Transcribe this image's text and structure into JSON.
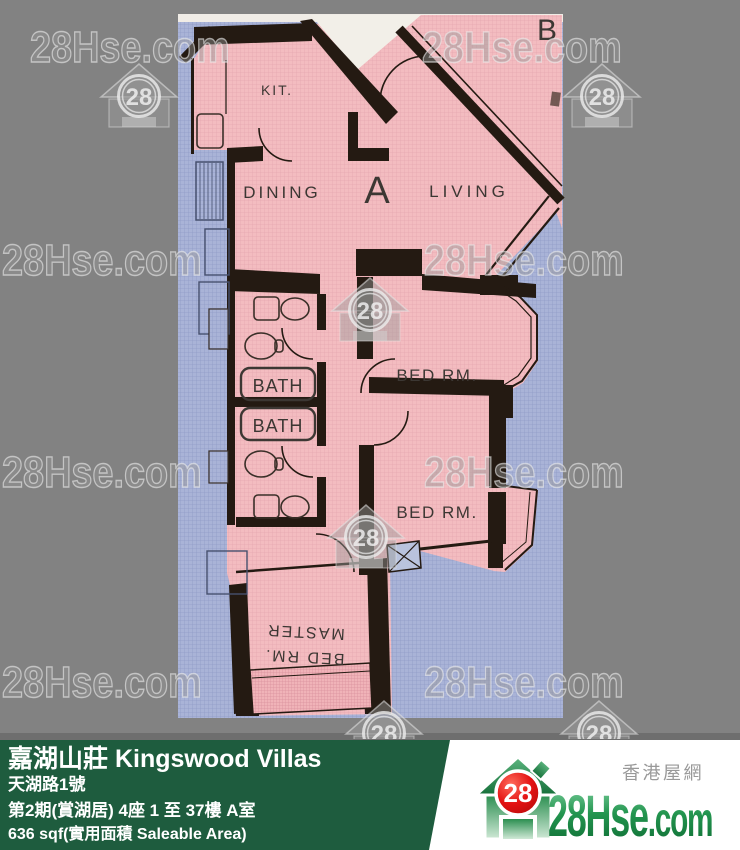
{
  "watermark": {
    "brand": "28Hse.com",
    "logo_number": "28"
  },
  "floor_plan": {
    "unit_label": "A",
    "adjacent_unit_label": "B",
    "labels": {
      "kitchen": "KIT.",
      "dining": "DINING",
      "living": "LIVING",
      "bath_upper": "BATH",
      "bath_lower": "BATH",
      "bedroom_1": "BED RM.",
      "bedroom_2": "BED RM.",
      "master_line_1": "MASTER",
      "master_line_2": "BED RM."
    },
    "colors": {
      "room_fill": "#f3bcc0",
      "outside_fill": "#a9b3d7",
      "wall": "#241a12",
      "lobby_fill": "#f2efe8"
    }
  },
  "info_bar": {
    "title": "嘉湖山莊 Kingswood Villas",
    "address": "天湖路1號",
    "block_info": "第2期(賞湖居) 4座 1 至 37樓 A室",
    "area_info": "636 sqf(實用面積 Saleable Area)",
    "bg_color": "#1e5c3e"
  },
  "brand": {
    "tagline": "香港屋網",
    "logo_number": "28",
    "name_main": "28Hse",
    "name_suffix": ".com",
    "green": "#1b8744",
    "red": "#e31212"
  }
}
